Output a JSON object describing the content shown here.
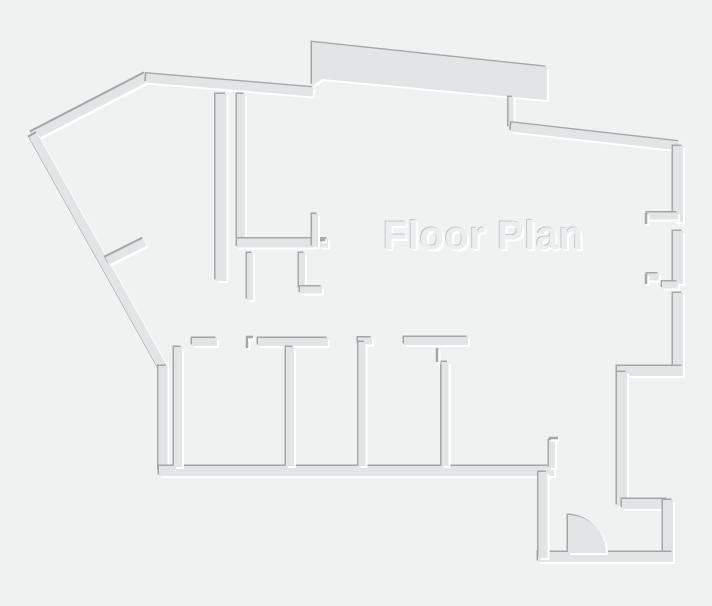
{
  "canvas": {
    "width": 712,
    "height": 606,
    "background": "#f0f1f1"
  },
  "title": {
    "text": "Floor Plan",
    "color": "#ebedee",
    "shadow_light": "#ffffff",
    "shadow_dark": "#c6c8c9"
  },
  "plan": {
    "wall_color": "#e2e4e5",
    "edge_dark": "#a4a6a7",
    "edge_light": "#ffffff",
    "polygons": [
      {
        "name": "top-thick-wall",
        "points": "312,42 547,67 547,100 513,97 322,79 312,86"
      }
    ],
    "walls": [
      {
        "name": "outer-apex-diagonal",
        "d": "M33 136L147 77",
        "w": 9
      },
      {
        "name": "outer-top-wall",
        "d": "M146 78L313 92",
        "w": 9
      },
      {
        "name": "outer-left-diagonal",
        "d": "M33 135L163 368",
        "w": 9
      },
      {
        "name": "outer-left-vertical",
        "d": "M163 366L163 471",
        "w": 9
      },
      {
        "name": "bottom-main-wall",
        "d": "M159 471L554 471",
        "w": 10
      },
      {
        "name": "step-jamb-wall",
        "d": "M511 97L511 128",
        "w": 5
      },
      {
        "name": "outer-top-right-wall",
        "d": "M511 127L679 146",
        "w": 9
      },
      {
        "name": "right-wall-upper",
        "d": "M678 146L678 222",
        "w": 10
      },
      {
        "name": "right-wall-middle",
        "d": "M678 231L678 284",
        "w": 10
      },
      {
        "name": "right-wall-lower",
        "d": "M678 293L678 376",
        "w": 10
      },
      {
        "name": "right-step-horizontal",
        "d": "M683 371L617 371",
        "w": 10
      },
      {
        "name": "right-mid-vertical",
        "d": "M622 372L622 506",
        "w": 10
      },
      {
        "name": "alcove-top",
        "d": "M622 504L668 504",
        "w": 10
      },
      {
        "name": "alcove-right",
        "d": "M668 500L668 558",
        "w": 10
      },
      {
        "name": "entry-bottom",
        "d": "M538 557L673 557",
        "w": 10
      },
      {
        "name": "entry-left",
        "d": "M543 472L543 558",
        "w": 9
      },
      {
        "name": "mid-vertical-long",
        "d": "M221 94L221 281",
        "w": 11
      },
      {
        "name": "mid-vertical-short",
        "d": "M241 94L241 246",
        "w": 8
      },
      {
        "name": "mid-horizontal",
        "d": "M237 243L315 243",
        "w": 9
      },
      {
        "name": "mid-horizontal-end",
        "d": "M319 243L328 243",
        "w": 9
      },
      {
        "name": "mid-upright",
        "d": "M315 214L315 247",
        "w": 6
      },
      {
        "name": "mid-stub-left",
        "d": "M250 253L250 300",
        "w": 6
      },
      {
        "name": "mid-stub-right",
        "d": "M302 253L302 289",
        "w": 6
      },
      {
        "name": "mid-stub-foot",
        "d": "M300 290L322 290",
        "w": 7
      },
      {
        "name": "closet-diagonal",
        "d": "M107 261L145 242",
        "w": 8
      },
      {
        "name": "room1-left-wall",
        "d": "M178 347L178 467",
        "w": 8
      },
      {
        "name": "room1-top-stub",
        "d": "M192 342L217 342",
        "w": 8
      },
      {
        "name": "rooms-top-wall-a",
        "d": "M258 342L328 342",
        "w": 8
      },
      {
        "name": "room-divider-1",
        "d": "M290 347L290 466",
        "w": 8
      },
      {
        "name": "room-divider-2-tick",
        "d": "M358 341L372 341",
        "w": 7
      },
      {
        "name": "room-divider-2",
        "d": "M362 342L362 466",
        "w": 7
      },
      {
        "name": "rooms-top-wall-b",
        "d": "M404 341L468 341",
        "w": 8
      },
      {
        "name": "room-divider-3",
        "d": "M445 362L445 466",
        "w": 7
      },
      {
        "name": "entry-door-jamb-wall",
        "d": "M552 440L552 468",
        "w": 6
      },
      {
        "name": "window-stub-upper",
        "d": "M647 216L678 216",
        "w": 7
      },
      {
        "name": "window-stub-lower-a",
        "d": "M647 277L659 277",
        "w": 7
      },
      {
        "name": "window-stub-lower-b",
        "d": "M662 285L678 285",
        "w": 7
      }
    ],
    "jambs": [
      {
        "name": "room1-door-jamb-v",
        "d": "M247 337L247 348"
      },
      {
        "name": "room1-door-jamb-h",
        "d": "M246 337L253 337"
      },
      {
        "name": "divider3-jamb",
        "d": "M437 348L437 362"
      },
      {
        "name": "entry-jamb-tick",
        "d": "M549 438L558 438"
      },
      {
        "name": "window-upper-jamb",
        "d": "M646 213L646 224"
      },
      {
        "name": "window-lower-jamb",
        "d": "M646 274L646 284"
      },
      {
        "name": "mid-horizontal-tick",
        "d": "M320 240L325 240"
      }
    ],
    "door": {
      "name": "door-swing",
      "d": "M568 515A38 38 0 0 1 606 553L568 553Z"
    },
    "shadow": {
      "dark_dx": -1.5,
      "dark_dy": -1.5,
      "light_dx": 2,
      "light_dy": 2
    }
  }
}
